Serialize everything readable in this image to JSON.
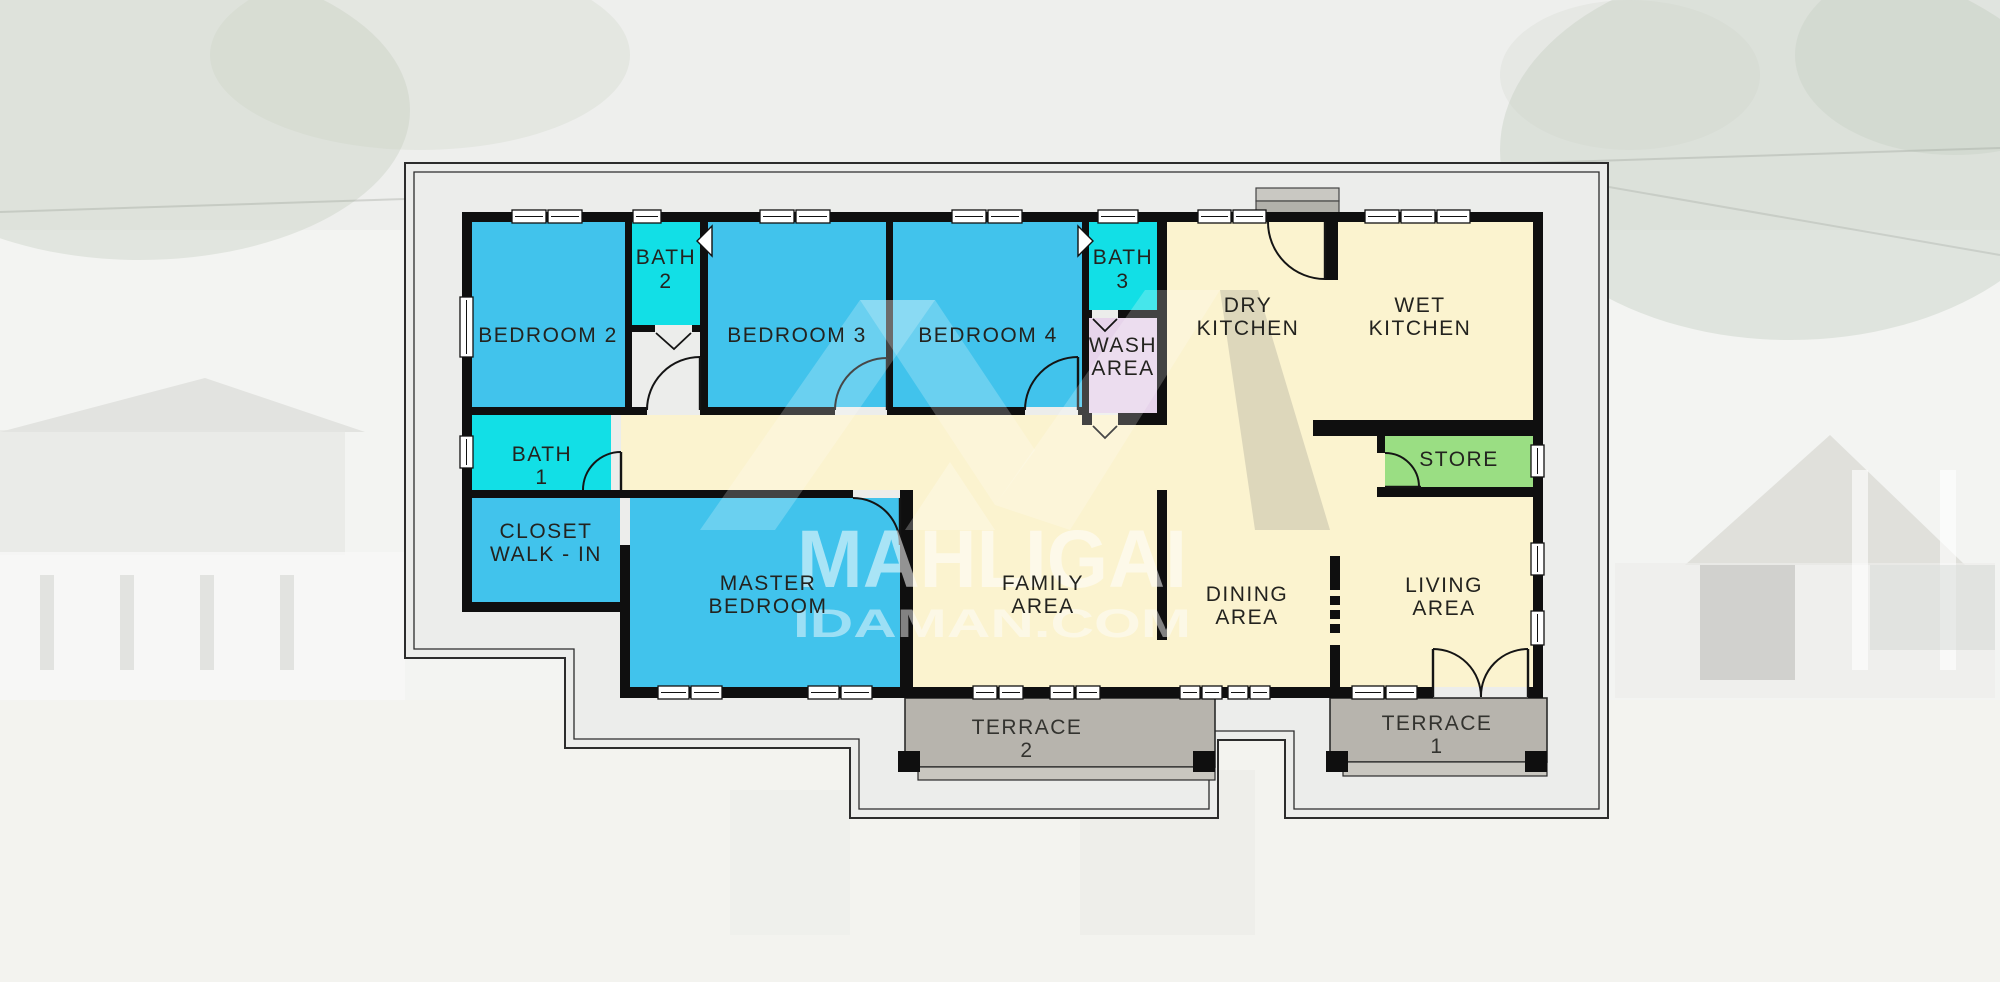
{
  "plan": {
    "rooms": {
      "bedroom2": {
        "label": "BEDROOM 2"
      },
      "bath2": {
        "lines": [
          "BATH",
          "2"
        ]
      },
      "bedroom3": {
        "label": "BEDROOM 3"
      },
      "bedroom4": {
        "label": "BEDROOM 4"
      },
      "bath3": {
        "lines": [
          "BATH",
          "3"
        ]
      },
      "wash": {
        "lines": [
          "WASH",
          "AREA"
        ]
      },
      "dry_kitchen": {
        "lines": [
          "DRY",
          "KITCHEN"
        ]
      },
      "wet_kitchen": {
        "lines": [
          "WET",
          "KITCHEN"
        ]
      },
      "store": {
        "label": "STORE"
      },
      "bath1": {
        "lines": [
          "BATH",
          "1"
        ]
      },
      "closet": {
        "lines": [
          "CLOSET",
          "WALK - IN"
        ]
      },
      "master_bedroom": {
        "lines": [
          "MASTER",
          "BEDROOM"
        ]
      },
      "family": {
        "lines": [
          "FAMILY",
          "AREA"
        ]
      },
      "dining": {
        "lines": [
          "DINING",
          "AREA"
        ]
      },
      "living": {
        "lines": [
          "LIVING",
          "AREA"
        ]
      },
      "terrace2": {
        "lines": [
          "TERRACE",
          "2"
        ]
      },
      "terrace1": {
        "lines": [
          "TERRACE",
          "1"
        ]
      }
    },
    "palette": {
      "bedroom_fill": "#41c3ec",
      "bathroom_fill": "#12dfe6",
      "wash_fill": "#e7d4eb",
      "common_fill": "#fbf3cf",
      "store_fill": "#9ade83",
      "terrace_fill": "#b7b4ad",
      "wall_color": "#0f0f0f",
      "eave_band": "#ecedeb"
    }
  },
  "watermark": {
    "brand": "MAHLIGAI",
    "domain": "IDAMAN.COM"
  }
}
